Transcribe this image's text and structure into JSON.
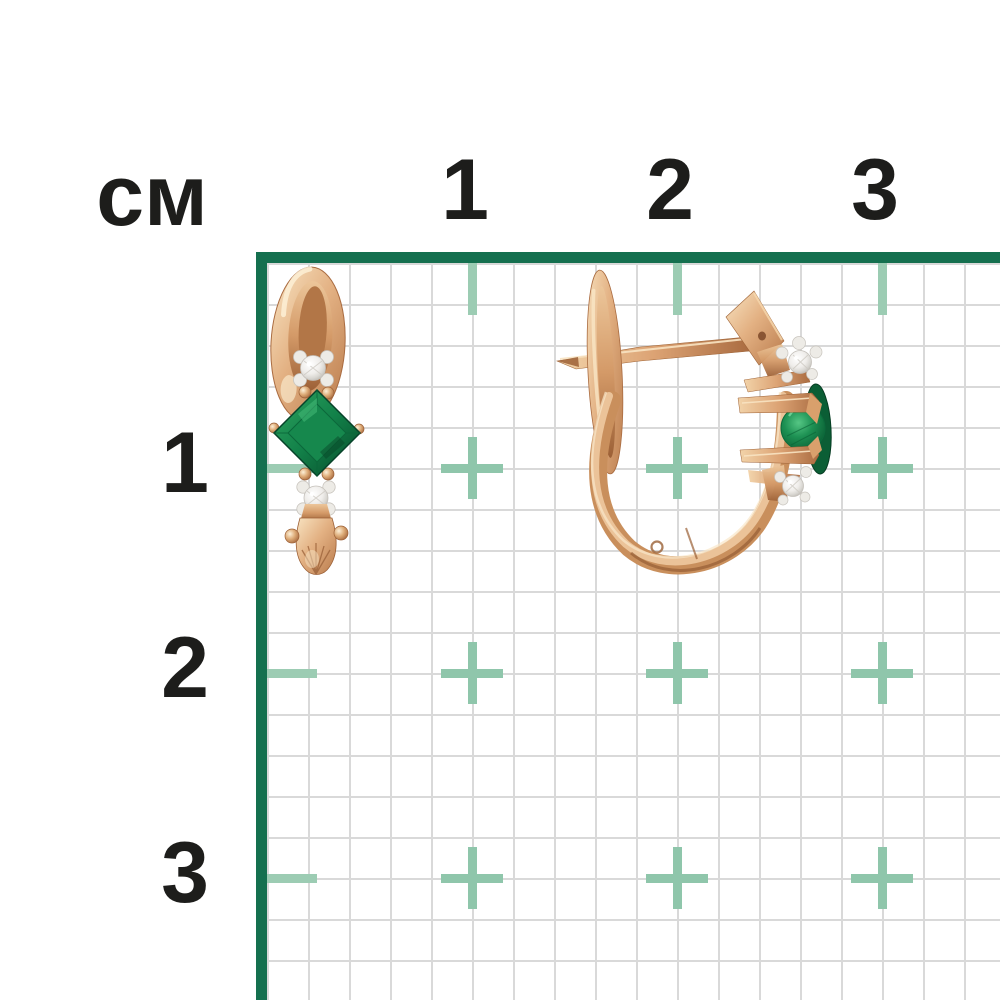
{
  "ruler": {
    "unit_label": "см",
    "top_labels": [
      "1",
      "2",
      "3"
    ],
    "left_labels": [
      "1",
      "2",
      "3"
    ]
  },
  "colors": {
    "frame_green": "#15704f",
    "cross_teal": "#8fc6ab",
    "tick_teal": "#9cccb3",
    "grid_line_gray": "#d9d9d9",
    "label_black": "#1d1d1b",
    "gold_light": "#f8e3c1",
    "gold_mid": "#d89a67",
    "gold_dark": "#a96a40",
    "emerald_green": "#16884d",
    "emerald_dark": "#0a5c33",
    "diamond_white": "#f4f2ee"
  }
}
